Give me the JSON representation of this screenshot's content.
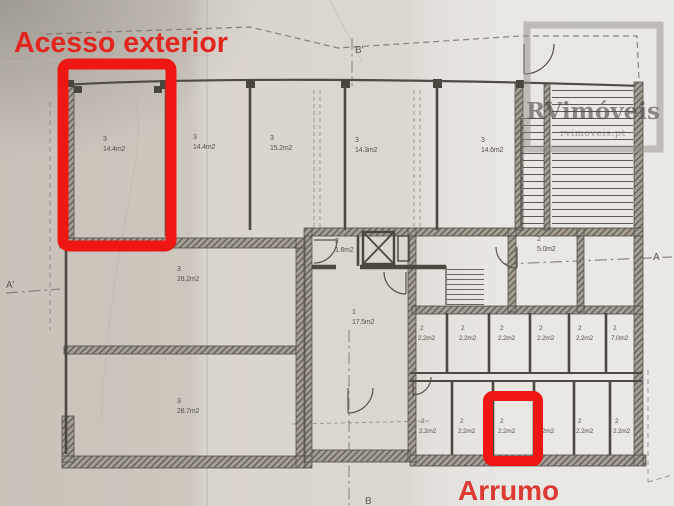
{
  "annotations": {
    "exterior_access_label": "Acesso exterior",
    "storage_unit_label": "Arrumo",
    "highlight_color": "#ee1713"
  },
  "watermark": {
    "brand": "RVimóveis",
    "website": "rvimoveis.pt"
  },
  "section_markers": {
    "left": "A'",
    "right": "A",
    "top": "B'",
    "bottom": "B"
  },
  "floor_plan": {
    "top_row_rooms": [
      {
        "unit": "3",
        "area": "14.4m2"
      },
      {
        "unit": "3",
        "area": "14.4m2"
      },
      {
        "unit": "3",
        "area": "15.2m2"
      },
      {
        "unit": "3",
        "area": "14.3m2"
      },
      {
        "unit": "3",
        "area": "14.6m2"
      }
    ],
    "middle_rooms": [
      {
        "unit": "3",
        "area": "28.2m2"
      },
      {
        "unit": "2",
        "area": "1.6m2"
      },
      {
        "unit": "1",
        "area": "17.5m2"
      },
      {
        "unit": "2",
        "area": "5.0m2"
      }
    ],
    "storage_row_upper": [
      {
        "unit": "2",
        "area": "2.2m2"
      },
      {
        "unit": "2",
        "area": "2.2m2"
      },
      {
        "unit": "2",
        "area": "2.2m2"
      },
      {
        "unit": "2",
        "area": "2.2m2"
      },
      {
        "unit": "2",
        "area": "2.2m2"
      },
      {
        "unit": "2",
        "area": "7.0m2"
      }
    ],
    "storage_row_lower": [
      {
        "unit": "2",
        "area": "2.2m2"
      },
      {
        "unit": "2",
        "area": "2.2m2"
      },
      {
        "unit": "2",
        "area": "2.2m2"
      },
      {
        "unit": "2",
        "area": "2.2m2"
      },
      {
        "unit": "2",
        "area": "2.2m2"
      },
      {
        "unit": "2",
        "area": "2.2m2"
      }
    ],
    "bottom_rooms": [
      {
        "unit": "3",
        "area": "28.7m2"
      }
    ]
  }
}
